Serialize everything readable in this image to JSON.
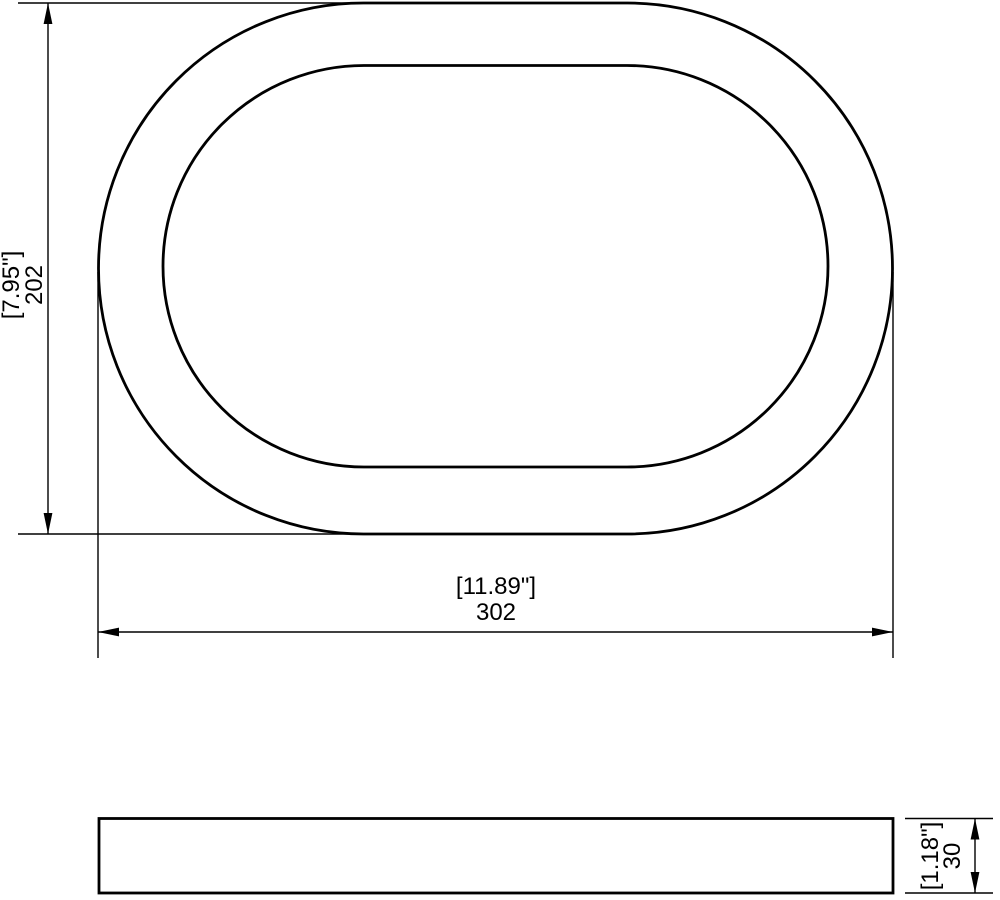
{
  "drawing": {
    "kind": "technical-dimension-drawing",
    "subject": "oval-ring",
    "background": "#ffffff",
    "line_color": "#000000",
    "top_view": {
      "height_dim": {
        "inches": "[7.95\"]",
        "mm": "202"
      },
      "width_dim": {
        "inches": "[11.89\"]",
        "mm": "302"
      }
    },
    "side_view": {
      "thickness_dim": {
        "inches": "[1.18\"]",
        "mm": "30"
      }
    }
  }
}
